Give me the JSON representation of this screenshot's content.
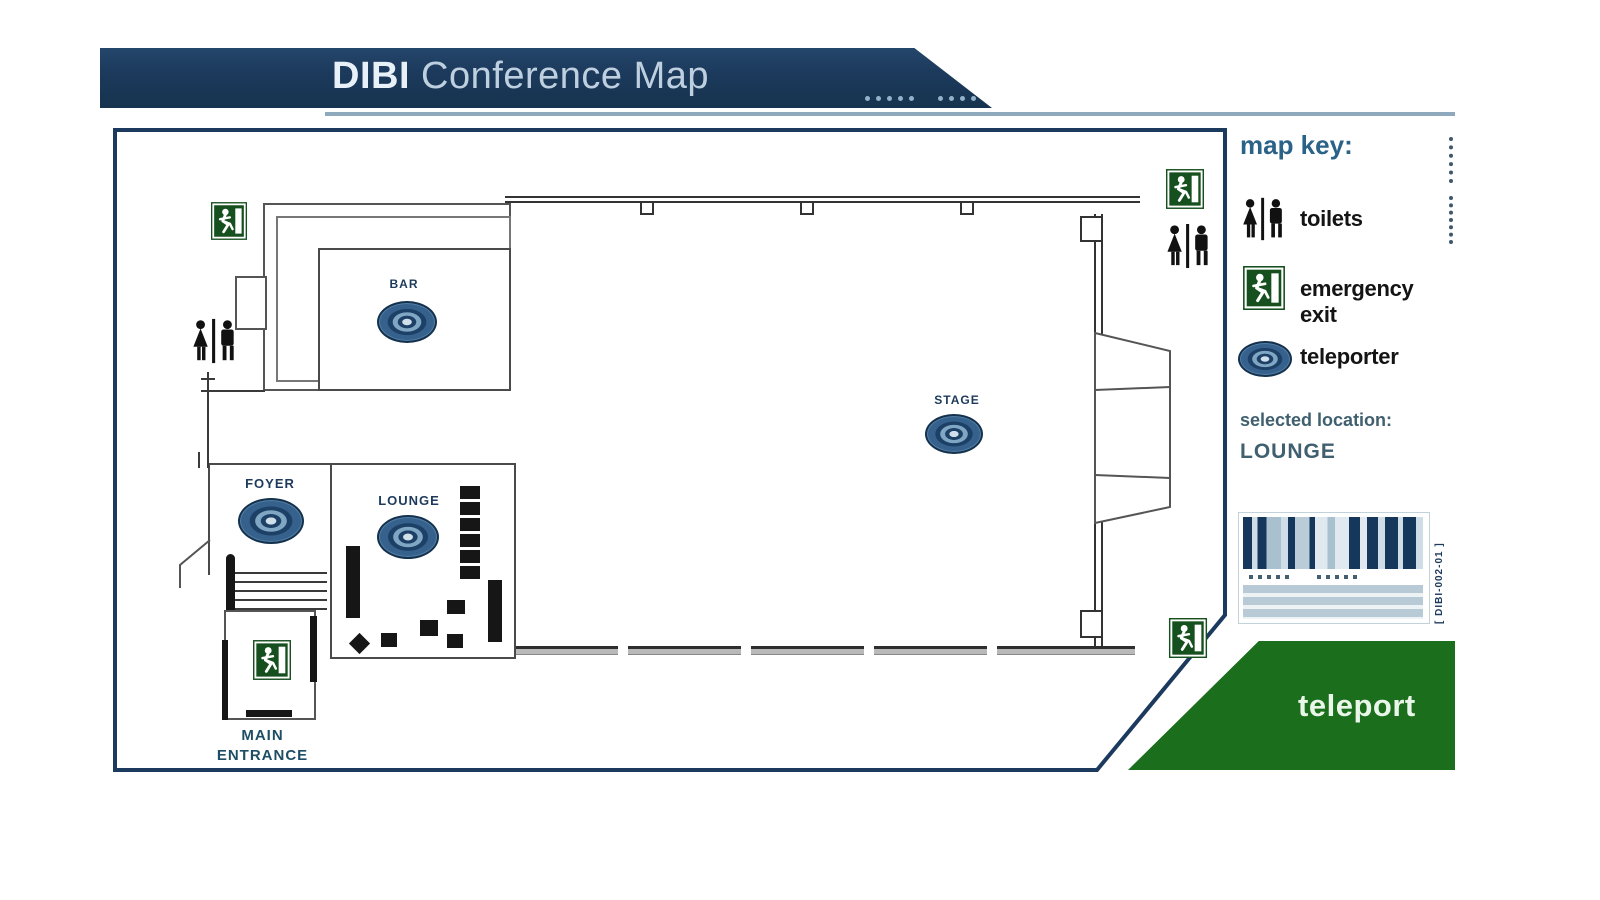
{
  "header": {
    "brand": "DIBI",
    "title": " Conference Map"
  },
  "map_key": {
    "heading": "map key:",
    "toilets_label": "toilets",
    "emergency_exit_label": "emergency exit",
    "teleporter_label": "teleporter"
  },
  "selected_location": {
    "label": "selected location:",
    "value": "LOUNGE"
  },
  "barcode": {
    "code": "[ DIBI-002-01 ]"
  },
  "actions": {
    "teleport_label": "teleport"
  },
  "rooms": {
    "bar": "BAR",
    "stage": "STAGE",
    "foyer": "FOYER",
    "lounge": "LOUNGE",
    "main_entrance": "MAIN ENTRANCE"
  },
  "colors": {
    "banner_navy": "#1c3a5c",
    "map_border": "#1c3a5e",
    "key_heading_blue": "#2b6288",
    "teleport_green": "#1b6e1b",
    "exit_sign_green": "#17501f",
    "teleporter_blue": "#2e5f8c",
    "location_teal": "#40606f"
  }
}
